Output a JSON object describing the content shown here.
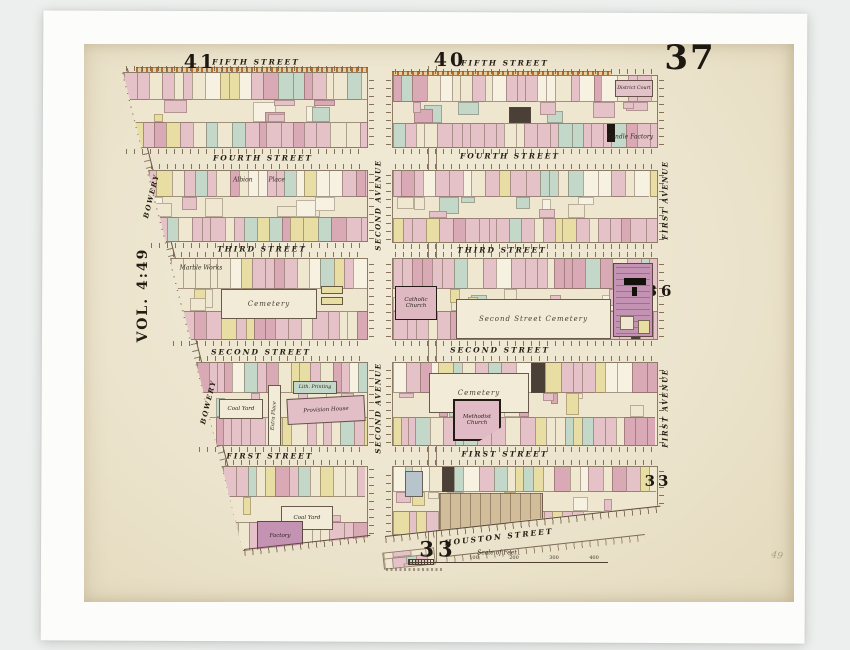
{
  "plate": {
    "number": "37",
    "volume": "VOL. 4:49",
    "neighbor_top_left": "41",
    "neighbor_top_right": "40",
    "neighbor_right_upper": "36",
    "neighbor_right_lower": "33",
    "neighbor_bottom": "33",
    "pencil_mark": "49"
  },
  "streets": {
    "fifth": "FIFTH STREET",
    "fourth": "FOURTH STREET",
    "third": "THIRD STREET",
    "second": "SECOND STREET",
    "first": "FIRST STREET",
    "houston": "HOUSTON STREET",
    "bowery": "BOWERY",
    "second_avenue": "SECOND AVENUE",
    "first_avenue": "FIRST AVENUE",
    "extra_place": "Extra Place",
    "albion_place": "Albion Place"
  },
  "landmarks": {
    "district_court": "District Court",
    "candle_factory": "Candle Factory",
    "marble_works": "Marble Works",
    "cemetery_west": "Cemetery",
    "catholic_church": "Catholic Church",
    "cemetery_center": "Second Street Cemetery",
    "cemetery_east": "Cemetery",
    "methodist_church": "Methodist Church",
    "coal_yard_upper": "Coal Yard",
    "provision_house": "Provision House",
    "lith_printing": "Lith. Printing",
    "coal_yard_lower": "Coal Yard",
    "factory": "Factory"
  },
  "scale_bar": {
    "title": "Scale of Feet",
    "ticks": [
      "100",
      "200",
      "300",
      "400"
    ]
  },
  "palette": {
    "paper": "#ede5cd",
    "pink": "#e4c2c8",
    "pink_deep": "#d9a9b6",
    "cream": "#efe7d0",
    "yellow": "#e8dea4",
    "green": "#c3d8c8",
    "white": "#f6f1e1",
    "tan": "#d2bd9b",
    "purple": "#c493b4",
    "dark": "#4a4038",
    "ink": "#241d14",
    "tick": "#76624c",
    "orange": "#b5702f"
  }
}
